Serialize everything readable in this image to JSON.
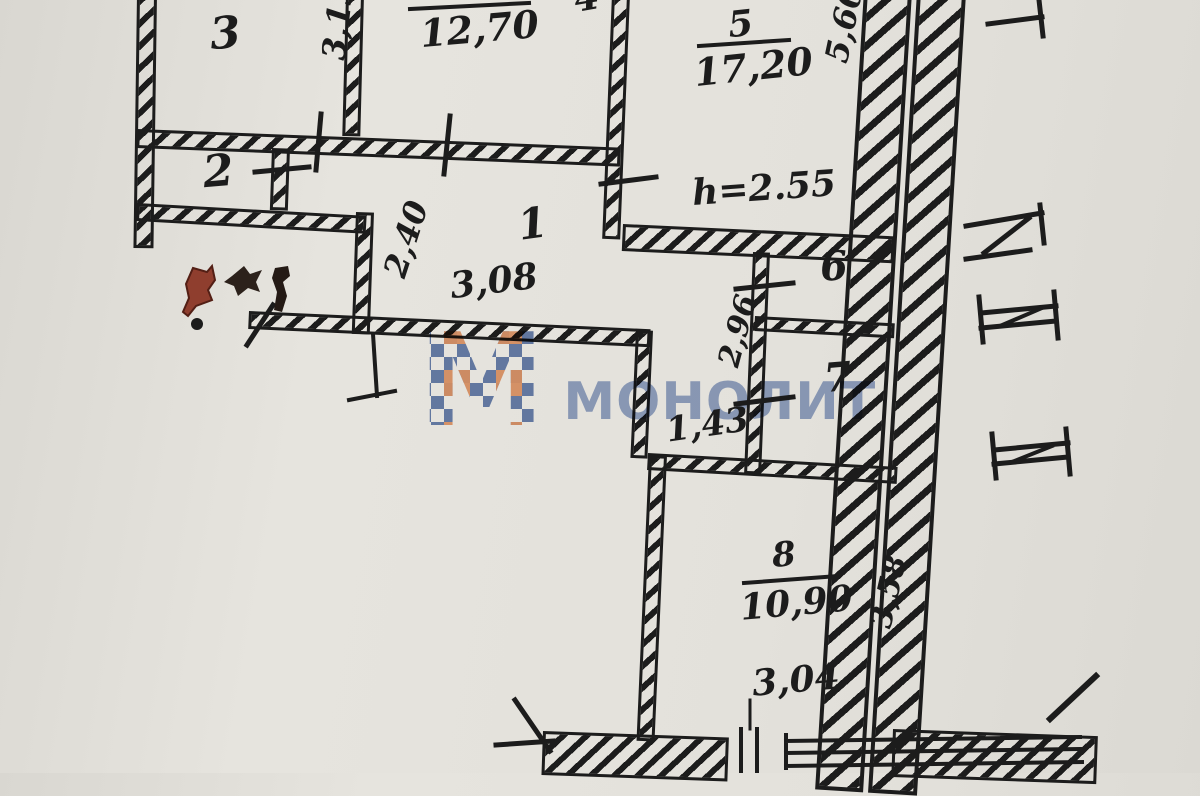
{
  "watermark": {
    "logo_letter": "М",
    "brand": "МОНОЛИТ"
  },
  "rooms": {
    "r1": {
      "number": "1"
    },
    "r2": {
      "number": "2"
    },
    "r3": {
      "number": "3"
    },
    "r4": {
      "number": "4",
      "area": "12,70"
    },
    "r5": {
      "number": "5",
      "area": "17,20"
    },
    "r6": {
      "number": "6"
    },
    "r7": {
      "number": "7"
    },
    "r8": {
      "number": "8",
      "area": "10,90"
    }
  },
  "dims": {
    "d313": "3,13",
    "d240": "2,40",
    "d308": "3,08",
    "d296": "2,96",
    "d143": "1,43",
    "d560": "5,60",
    "d358": "3,58",
    "d304": "3,04",
    "h255": "h=2.55"
  },
  "colors": {
    "paper": "#e3e1db",
    "ink": "#1c1c1c",
    "watermark_blue": "#5d79b0",
    "watermark_orange": "#eb9e6f",
    "stamp_red": "#8f3e2e"
  }
}
